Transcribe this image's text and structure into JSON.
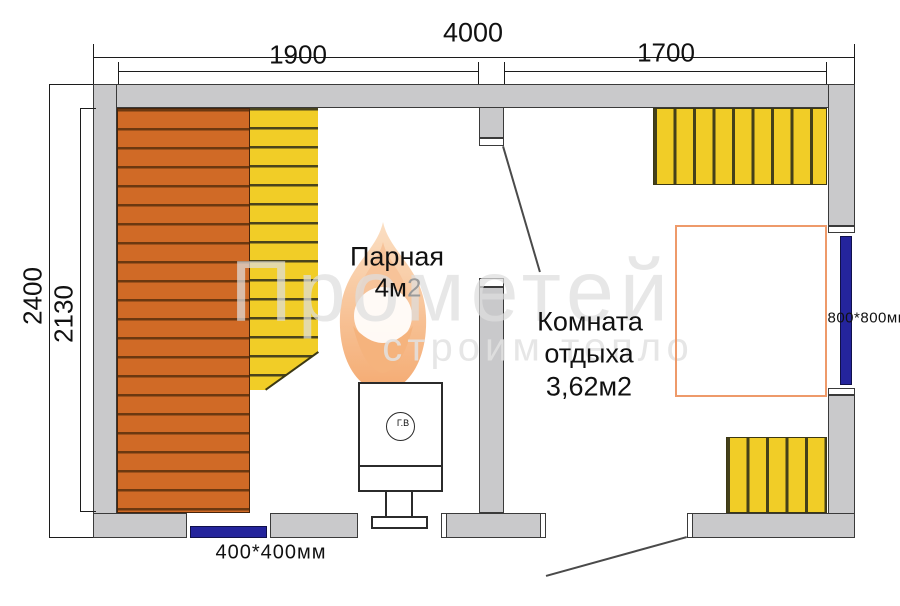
{
  "drawing": {
    "dims": {
      "overall_width": "4000",
      "left_room_width": "1900",
      "right_room_width": "1700",
      "overall_depth": "2400",
      "inner_depth": "2130"
    },
    "windows": {
      "bottom_label": "400*400мм",
      "right_label": "800*800мм"
    },
    "rooms": {
      "steam": {
        "name": "Парная",
        "area_main": "4м",
        "area_sup": "2"
      },
      "rest": {
        "name_line1": "Комната",
        "name_line2": "отдыха",
        "area": "3,62м2"
      }
    },
    "stove": {
      "tank_label": "Г.В"
    },
    "watermark": {
      "brand": "Прометей",
      "tagline": "строим тепло"
    },
    "colors": {
      "wall": "#c9c9cb",
      "bench_orange": "#d06a26",
      "bench_yellow": "#f1cd27",
      "window_blue": "#24249c",
      "table_outline": "#ee9a6a",
      "flame": "#f5ab70"
    }
  }
}
